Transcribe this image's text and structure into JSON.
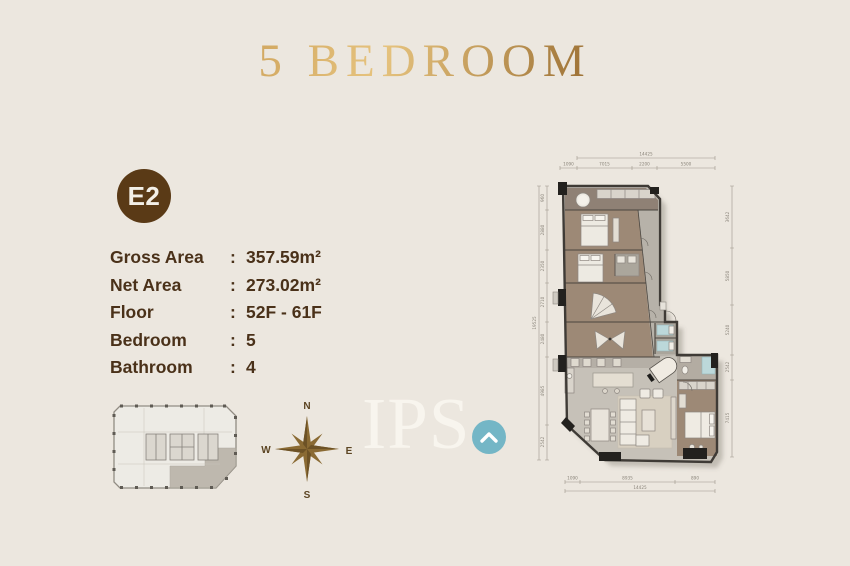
{
  "title": "5 BEDROOM",
  "unit_badge": "E2",
  "details": {
    "rows": [
      {
        "label": "Gross Area",
        "colon": ":",
        "value": "357.59m²"
      },
      {
        "label": "Net Area",
        "colon": ":",
        "value": "273.02m²"
      },
      {
        "label": "Floor",
        "colon": ":",
        "value": "52F - 61F"
      },
      {
        "label": "Bedroom",
        "colon": ":",
        "value": "5"
      },
      {
        "label": "Bathroom",
        "colon": ":",
        "value": "4"
      }
    ]
  },
  "compass": {
    "north": "N",
    "east": "E",
    "south": "S",
    "west": "W"
  },
  "watermark": {
    "text": "IPS",
    "icon": "chevron-up-icon",
    "circle_color": "#74b6c6"
  },
  "colors": {
    "background": "#ece7df",
    "title_gold": "#b08a44",
    "badge_brown": "#5a3a16",
    "text_brown": "#4a3119",
    "compass_gold": "#8a6a33",
    "watermark_white": "#f8f5ee",
    "watermark_teal": "#74b6c6",
    "keyplan_highlight": "#b6b0a5",
    "plan_bedroom_floor": "#9d8976",
    "plan_living_floor": "#c6c1b8",
    "plan_bath_accent": "#bcd8da",
    "plan_wall": "#3f3b36"
  },
  "floorplan": {
    "dim": {
      "top": {
        "total": "14425",
        "segments": [
          "1090",
          "7015",
          "2200",
          "5500"
        ]
      },
      "bottom": {
        "total": "14425",
        "segments": [
          "1090",
          "8935",
          "890"
        ]
      },
      "left": {
        "total": "19525",
        "segments": [
          "960",
          "2880",
          "2350",
          "2710",
          "2480",
          "4985",
          "2542"
        ]
      },
      "right": {
        "segments": [
          "3642",
          "5850",
          "5240",
          "2542",
          "7415"
        ]
      }
    }
  }
}
